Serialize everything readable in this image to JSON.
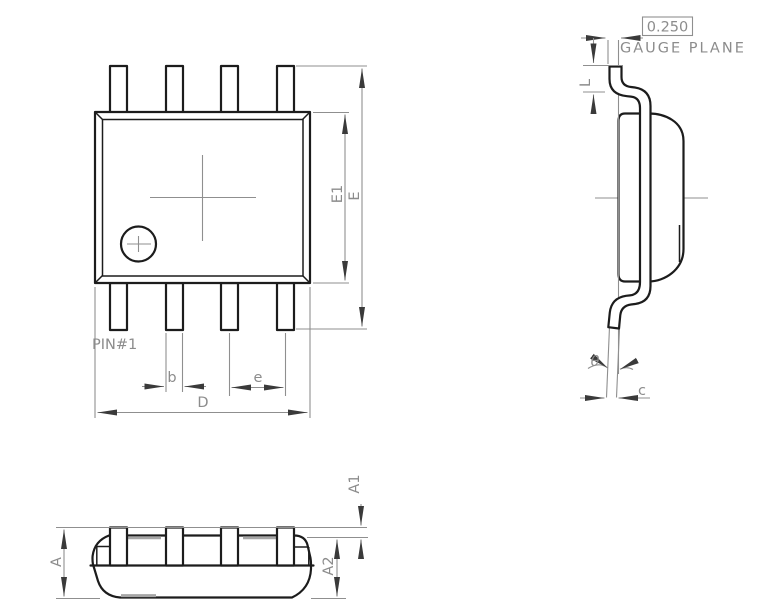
{
  "drawing": {
    "labels": {
      "pin1": "PIN#1",
      "b": "b",
      "e": "e",
      "D": "D",
      "E1": "E1",
      "E": "E",
      "A": "A",
      "A1": "A1",
      "A2": "A2",
      "L": "L",
      "theta": "θ",
      "c": "c",
      "gauge_value": "0.250",
      "gauge_plane": "GAUGE PLANE"
    },
    "colors": {
      "object_line": "#1c1c1c",
      "dimension_line": "#8f8f8f",
      "label_text": "#8c8c8c",
      "arrowhead": "#3a3a3a",
      "mold_mark": "#a6a6a6",
      "background": "#ffffff"
    }
  }
}
